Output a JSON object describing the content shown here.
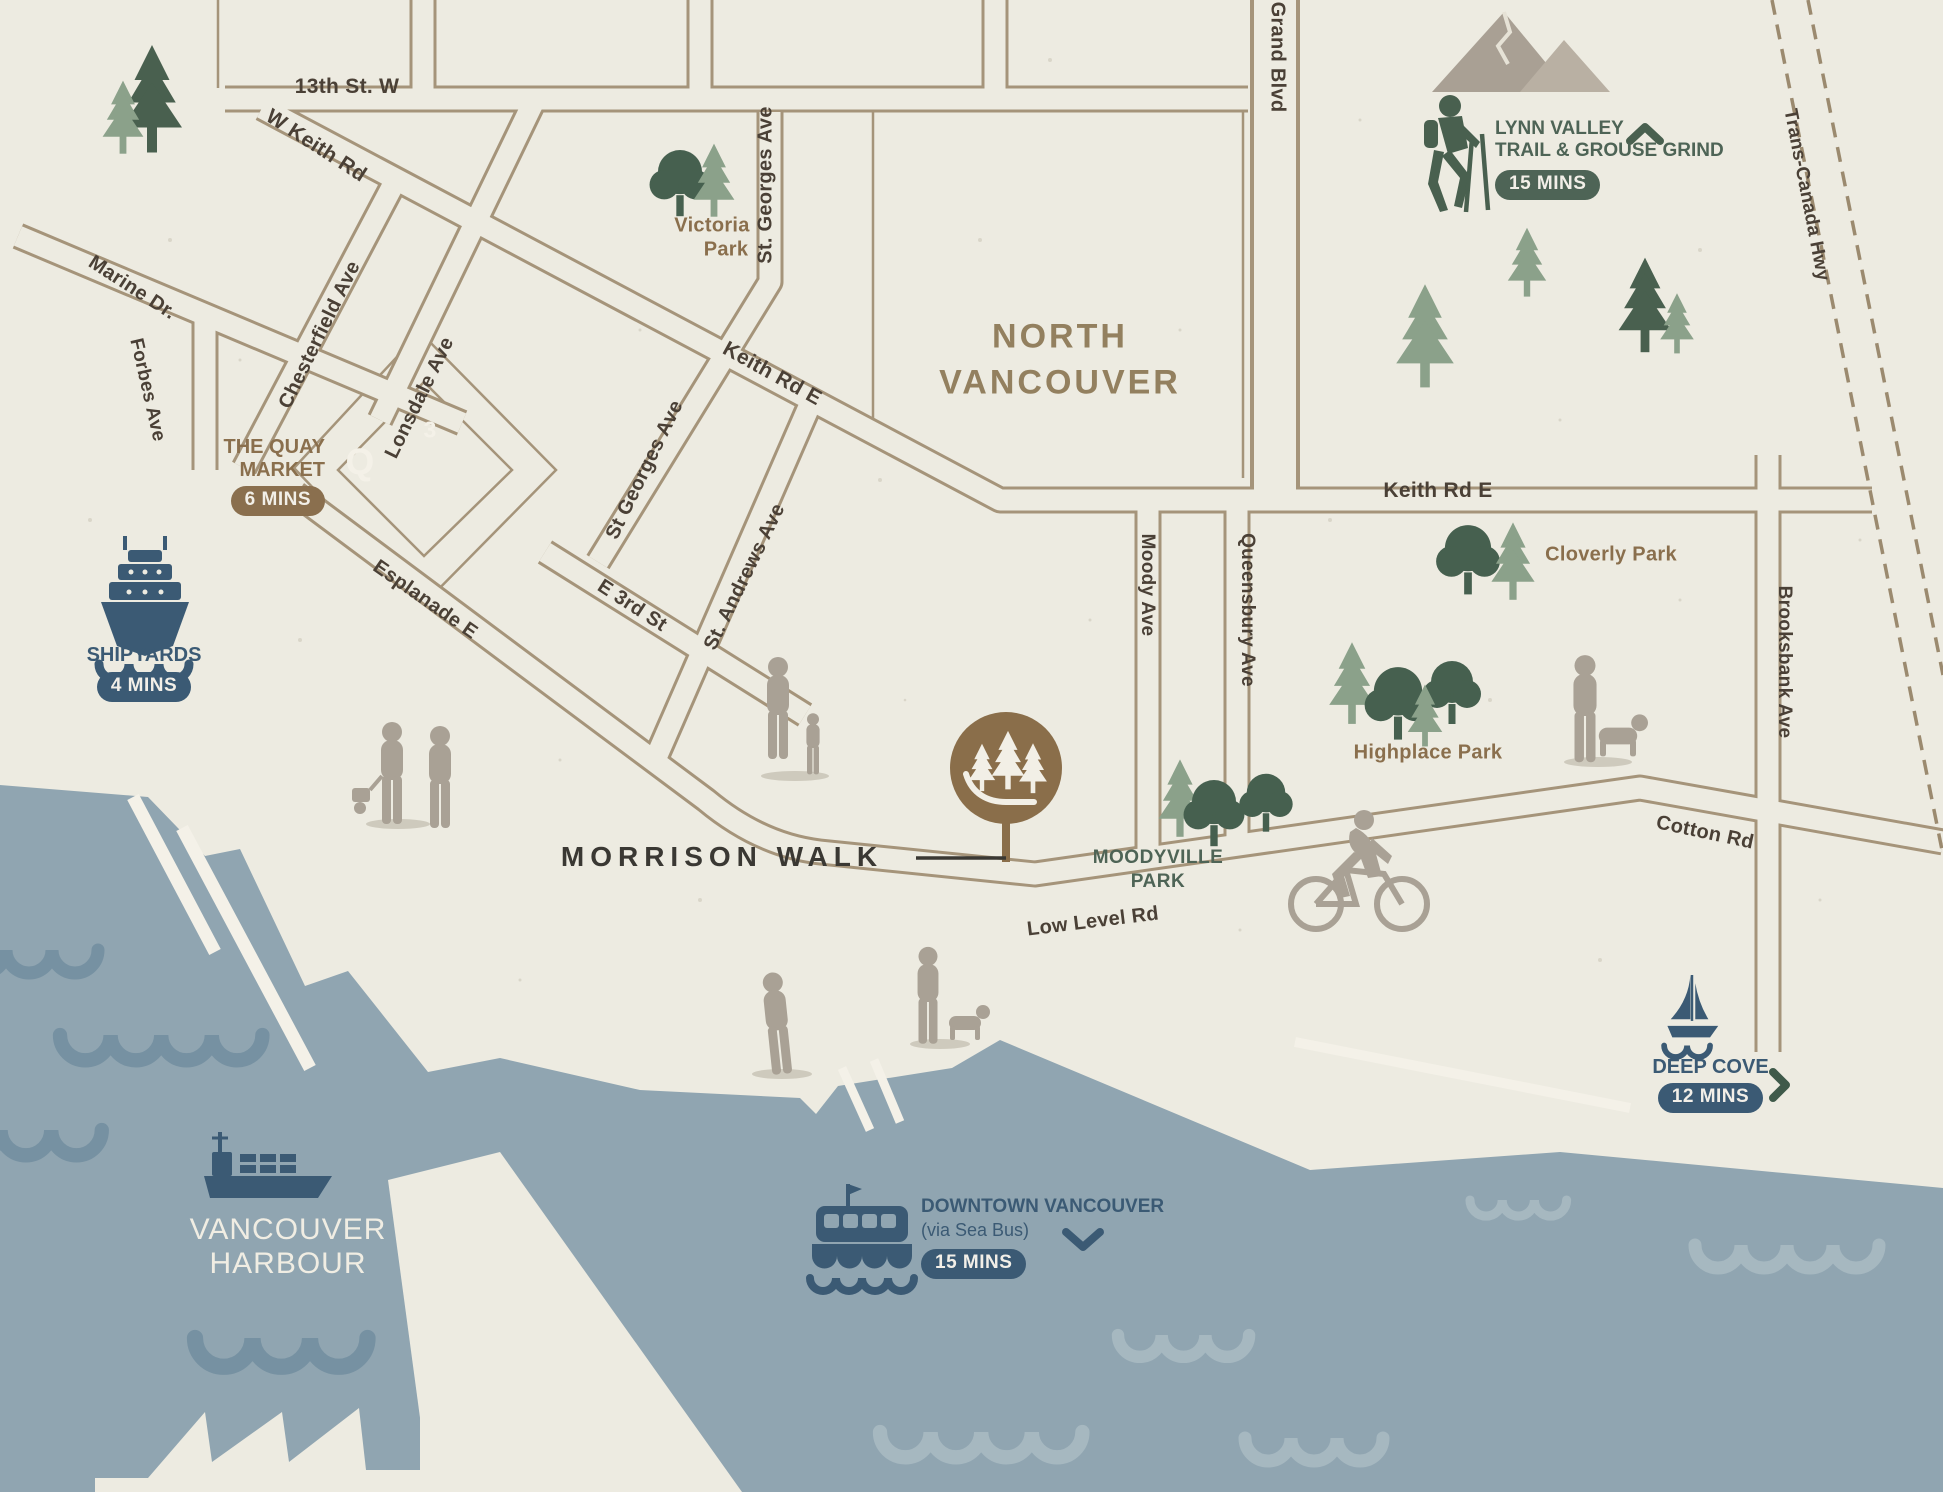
{
  "title": "Morrison Walk neighbourhood location map, North Vancouver",
  "project": {
    "name": "MORRISON WALK"
  },
  "area_labels": {
    "north_vancouver_line1": "NORTH",
    "north_vancouver_line2": "VANCOUVER",
    "vancouver_harbour_line1": "VANCOUVER",
    "vancouver_harbour_line2": "HARBOUR"
  },
  "streets": {
    "thirteenth": "13th St. W",
    "w_keith": "W Keith Rd",
    "marine": "Marine Dr.",
    "forbes": "Forbes Ave",
    "chesterfield": "Chesterfield Ave",
    "lonsdale": "Lonsdale Ave",
    "st_georges_diag": "St Georges Ave",
    "st_georges_vert": "St. Georges Ave",
    "st_andrews": "St. Andrews Ave",
    "keith_diag": "Keith Rd E",
    "keith_east": "Keith Rd E",
    "e_3rd": "E 3rd St",
    "esplanade": "Esplanade E",
    "grand_blvd": "Grand Blvd",
    "moody": "Moody Ave",
    "queensbury": "Queensbury Ave",
    "brooksbank": "Brooksbank Ave",
    "trans_canada": "Trans-Canada Hwy",
    "low_level": "Low Level Rd",
    "cotton": "Cotton Rd"
  },
  "parks": {
    "victoria_line1": "Victoria",
    "victoria_line2": "Park",
    "cloverly": "Cloverly Park",
    "highplace": "Highplace Park",
    "moodyville_line1": "MOODYVILLE",
    "moodyville_line2": "PARK"
  },
  "pois": {
    "quay": {
      "line1": "THE QUAY",
      "line2": "MARKET",
      "time": "6 MINS"
    },
    "shipyards": {
      "name": "SHIPYARDS",
      "time": "4 MINS"
    },
    "lynn_valley": {
      "line1": "LYNN VALLEY",
      "line2": "TRAIL & GROUSE GRIND",
      "time": "15 MINS"
    },
    "deep_cove": {
      "name": "DEEP COVE",
      "time": "12 MINS"
    },
    "downtown": {
      "line1": "DOWNTOWN VANCOUVER",
      "line2": "(via Sea Bus)",
      "time": "15 MINS"
    }
  },
  "markers": {
    "quay_q": "Q",
    "numeral_3": "3"
  },
  "icons": {
    "morrison-walk-marker": "brown circle with three white pines and path swoosh",
    "cruise-ship-icon": "navy cruise ship bow view",
    "container-ship-icon": "navy container ship",
    "seabus-ferry-icon": "navy SeaBus ferry",
    "sailboat-icon": "navy sailboat",
    "hiker-icon": "green hiker with poles",
    "mountains-icon": "grey twin peaks",
    "pine-tree-icon": "conifer tree",
    "round-tree-icon": "deciduous tree",
    "cyclist-icon": "grey cyclist silhouette",
    "pedestrian-icon": "grey pedestrian silhouette",
    "dog-icon": "grey dog silhouette",
    "chevron-up-icon": "up arrow",
    "chevron-right-icon": "right arrow",
    "chevron-down-icon": "down arrow",
    "wave-icon": "scalloped water wave"
  },
  "colors": {
    "paper": "#edebe1",
    "water": "#90a5b1",
    "wave_dark": "#7691a2",
    "wave_light": "#a6b8c0",
    "navy": "#3b5a74",
    "green_dark": "#4e6456",
    "sage": "#8ba18a",
    "brown": "#8a6f4e",
    "road_outline": "#a5947a",
    "street_text": "#4a4036",
    "tan_text": "#93805f",
    "silhouette_gray": "#a9a195",
    "cream": "#f2efe6"
  }
}
